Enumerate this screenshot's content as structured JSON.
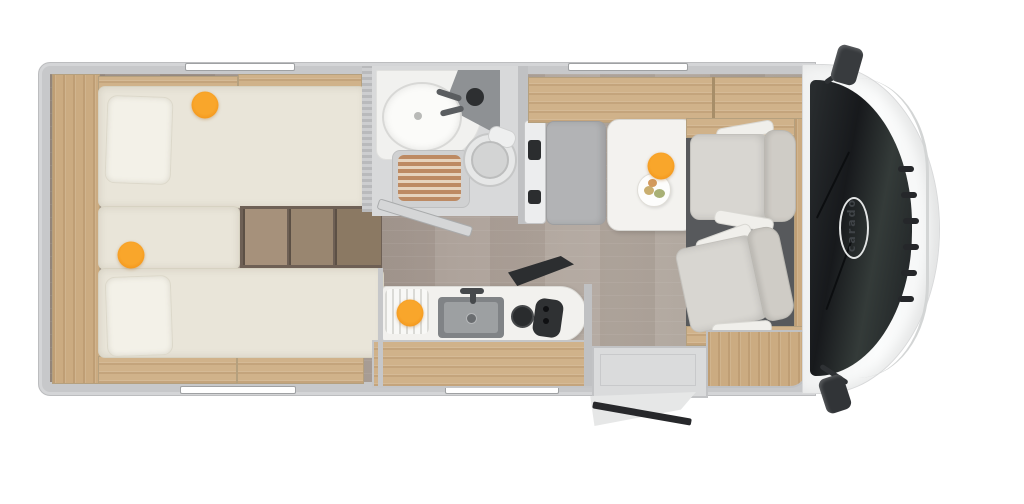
{
  "vehicle": {
    "brand_logo_text": "carado"
  },
  "colors": {
    "accent_orange": "#F39515",
    "body_wall_gray": "#C7C8CA",
    "floor_wood": "#9D928A",
    "furniture_wood": "#D0B28A",
    "mattress_ivory": "#E9E5D9",
    "seat_gray": "#D8D6D1",
    "bench_gray": "#B2B3B5",
    "windshield_dark": "#1C1F22",
    "shower_slats_copper": "#BD8A63"
  },
  "hotspots": [
    {
      "id": "rear-bed-top",
      "x": 205,
      "y": 105
    },
    {
      "id": "rear-bed-bottom",
      "x": 131,
      "y": 255
    },
    {
      "id": "kitchen",
      "x": 410,
      "y": 313
    },
    {
      "id": "dinette-table",
      "x": 661,
      "y": 166
    }
  ]
}
